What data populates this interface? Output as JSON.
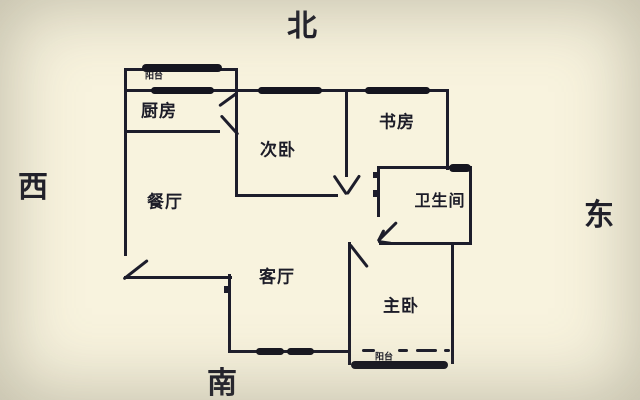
{
  "diagram_type": "apartment-floor-plan",
  "compass": {
    "north": "北",
    "south": "南",
    "east": "东",
    "west": "西"
  },
  "rooms": {
    "kitchen": {
      "label": "厨房"
    },
    "second_bedroom": {
      "label": "次卧"
    },
    "study": {
      "label": "书房"
    },
    "dining": {
      "label": "餐厅"
    },
    "bathroom": {
      "label": "卫生间"
    },
    "living": {
      "label": "客厅"
    },
    "master_bedroom": {
      "label": "主卧"
    },
    "north_balcony": {
      "label": "阳台"
    },
    "south_balcony": {
      "label": "阳台"
    }
  },
  "colors": {
    "background": "#f8f3de",
    "line": "#1d1d2b"
  }
}
